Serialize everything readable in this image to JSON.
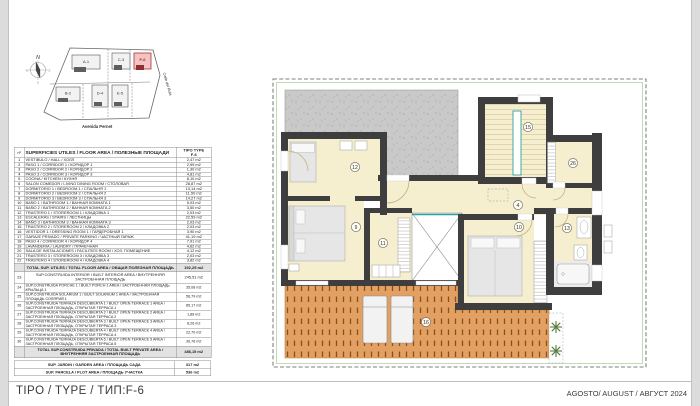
{
  "meta": {
    "type_label": "TIPO / TYPE / ТИП:F-6",
    "date_label": "AGOSTO/ AUGUST / АВГУСТ 2024"
  },
  "site_plan": {
    "north_label": "N",
    "street_bottom": "Avenida Pernet",
    "street_right": "Calle del Rubi",
    "highlighted_unit": "F-6",
    "highlight_color": "#b03030",
    "buildings": [
      {
        "label": "A-1"
      },
      {
        "label": "C-3"
      },
      {
        "label": "F-6"
      },
      {
        "label": "B-2"
      },
      {
        "label": "D-4"
      },
      {
        "label": "E-5"
      }
    ]
  },
  "table": {
    "header": {
      "num_label": "nº",
      "title": "SUPERFICIES UTILES / FLOOR AREA / ПОЛЕЗНЫЕ ПЛОЩАДИ",
      "type_label": "TIPO TYPE",
      "type_value": "F-6"
    },
    "rows": [
      {
        "num": "1",
        "name": "VESTIBULO / HALL / ХОЛЛ",
        "value": "2,47 m2"
      },
      {
        "num": "2",
        "name": "PASO 1 / CORRIDOR 1 / КОРИДОР 1",
        "value": "2,99 m2"
      },
      {
        "num": "3",
        "name": "PASO 2 / CORRIDOR 2 / КОРИДОР 2",
        "value": "1,30 m2"
      },
      {
        "num": "4",
        "name": "PASO 3 / CORRIDOR 3 / КОРИДОР 3",
        "value": "4,81 m2"
      },
      {
        "num": "5",
        "name": "COCINA / KITCHEN / КУХНЯ",
        "value": "8,10 m2"
      },
      {
        "num": "6",
        "name": "SALON COMEDOR / LIVING DINING ROOM / СТОЛОВАЯ",
        "value": "28,87 m2"
      },
      {
        "num": "7",
        "name": "DORMITORIO 1 / BEDROOM 1 / СПАЛЬНЯ 1",
        "value": "13,14 m2"
      },
      {
        "num": "8",
        "name": "DORMITORIO 2 / BEDROOM 2 / СПАЛЬНЯ 2",
        "value": "11,50 m2"
      },
      {
        "num": "9",
        "name": "DORMITORIO 3 / BEDROOM 3 / СПАЛЬНЯ 3",
        "value": "14,27 m2"
      },
      {
        "num": "10",
        "name": "BAÑO 1 / BATHROOM 1 / ВАННАЯ КОМНАТА 1",
        "value": "5,03 m2"
      },
      {
        "num": "11",
        "name": "BAÑO 2 / BATHROOM 2 / ВАННАЯ КОМНАТА 2",
        "value": "3,50 m2"
      },
      {
        "num": "12",
        "name": "TRASTERO 1 / STOREROOM 1 / КЛАДОВКА 1",
        "value": "2,03 m2"
      },
      {
        "num": "13",
        "name": "ESCALERAS / STAIRS / ЛЕСТНИЦЫ",
        "value": "22,59 m2"
      },
      {
        "num": "14",
        "name": "BAÑO 3 / BATHROOM 3 / ВАННАЯ КОМНАТА 3",
        "value": "2,03 m2"
      },
      {
        "num": "15",
        "name": "TRASTERO 2 / STOREROOM 2 / КЛАДОВКА 2",
        "value": "2,03 m2"
      },
      {
        "num": "16",
        "name": "VESTIDOR 1 / DRESSING ROOM 1 / ГАРДЕРОБНАЯ 1",
        "value": "3,90 m2"
      },
      {
        "num": "17",
        "name": "GARAJE PRIVADO / PRIVATE PARKING / ЧАСТНЫЙ ГАРАЖ",
        "value": "41,19 m2"
      },
      {
        "num": "18",
        "name": "PASO 4 / CORRIDOR 4 / КОРИДОР 4",
        "value": "7,91 m2"
      },
      {
        "num": "19",
        "name": "LAVANDERIA / LAUNDRY / ПРАЧЕЧНАЯ",
        "value": "4,62 m2"
      },
      {
        "num": "20",
        "name": "SALA DE INSTALACIONES / FACILITIES ROOM / ХОЗ. ПОМЕЩЕНИЕ",
        "value": "4,12 m2"
      },
      {
        "num": "21",
        "name": "TRASTERO 3 / STOREROOM 3 / КЛАДОВКА 3",
        "value": "2,03 m2"
      },
      {
        "num": "22",
        "name": "TRASTERO 4 / STOREROOM 4 / КЛАДОВКА 4",
        "value": "3,82 m2"
      }
    ],
    "total_useful": {
      "label": "TOTAL SUP. UTILES / TOTAL FLOOR AREA / ОБЩАЯ ПОЛЕЗНАЯ ПЛОЩАДЬ",
      "value": "192,25 m2"
    },
    "built_interior": {
      "num": "23",
      "label": "SUP.CONSTRUIDA INTERIOR / BUILT INTERIOR AREA / ВНУТРЕННЯЯ ЗАСТРОЕННАЯ ПЛОЩАДЬ",
      "value": "245,51 m2"
    },
    "built_rows": [
      {
        "num": "24",
        "name": "SUP.CONSTRUIDA PORCHE 1 / BUILT PORCH 1 AREA / ЗАСТРОЕННАЯ ПЛОЩАДЬ КРЫЛЬЦА 1",
        "value": "35,08 m2"
      },
      {
        "num": "25",
        "name": "SUP.CONSTRUIDA SOLARIUM 1 / BUILT SOLARIUM 1 AREA / ЗАСТРОЕННАЯ ПЛОЩАДЬ СОЛЯРИЙ 1",
        "value": "56,79 m2"
      },
      {
        "num": "26",
        "name": "SUP.CONSTRUIDA TERRAZA DESCUBIERTA 1 / BUILT OPEN TERRACE 1 AREA / ЗАСТРОЕННАЯ ПЛОЩАДЬ, ОТКРЫТАЯ ТЕРРАСА 1",
        "value": "85,17 m2"
      },
      {
        "num": "27",
        "name": "SUP.CONSTRUIDA TERRAZA DESCUBIERTA 2 / BUILT OPEN TERRACE 2 AREA / ЗАСТРОЕННАЯ ПЛОЩАДЬ, ОТКРЫТАЯ ТЕРРАСА 2",
        "value": "1,88 m2"
      },
      {
        "num": "28",
        "name": "SUP.CONSTRUIDA TERRAZA DESCUBIERTA 3 / BUILT OPEN TERRACE 3 AREA / ЗАСТРОЕННАЯ ПЛОЩАДЬ, ОТКРЫТАЯ ТЕРРАСА 3",
        "value": "8,26 m2"
      },
      {
        "num": "29",
        "name": "SUP.CONSTRUIDA TERRAZA DESCUBIERTA 4 / BUILT OPEN TERRACE 4 AREA / ЗАСТРОЕННАЯ ПЛОЩАДЬ, ОТКРЫТАЯ ТЕРРАСА 4",
        "value": "22,70 m2"
      },
      {
        "num": "30",
        "name": "SUP.CONSTRUIDA TERRAZA DESCUBIERTA 5 / BUILT OPEN TERRACE 5 AREA / ЗАСТРОЕННАЯ ПЛОЩАДЬ, ОТКРЫТАЯ ТЕРРАСА 5",
        "value": "30,76 m2"
      }
    ],
    "total_built": {
      "label": "TOTAL SUP.CONSTRUIDA PRIVADA / TOTAL BUILT PRIVATE AREA / ВНУТРЕННЯЯ ЗАСТРОЕННАЯ ПЛОЩАДЬ",
      "value": "486,15 m2"
    },
    "garden": {
      "label": "SUP. JARDIN / GARDEN AREA / ПЛОЩАДЬ САДА",
      "value": "317 m2"
    },
    "plot": {
      "label": "SUP. PARCELA / PLOT AREA / ПЛОЩАДЬ УЧАСТКА",
      "value": "536 m2"
    }
  },
  "floor_plan": {
    "markers": [
      "12",
      "9",
      "11",
      "15",
      "26",
      "4",
      "10",
      "13",
      "16"
    ],
    "colors": {
      "floor": "#f6efcf",
      "roof_terrace": "#c9c9c9",
      "deck_terrace": "#e2a063",
      "wall": "#3e3e3e",
      "accent_teal": "#2fa0a0",
      "plant_green": "#5a7c3c",
      "boundary_green": "#bfdcb2"
    }
  }
}
